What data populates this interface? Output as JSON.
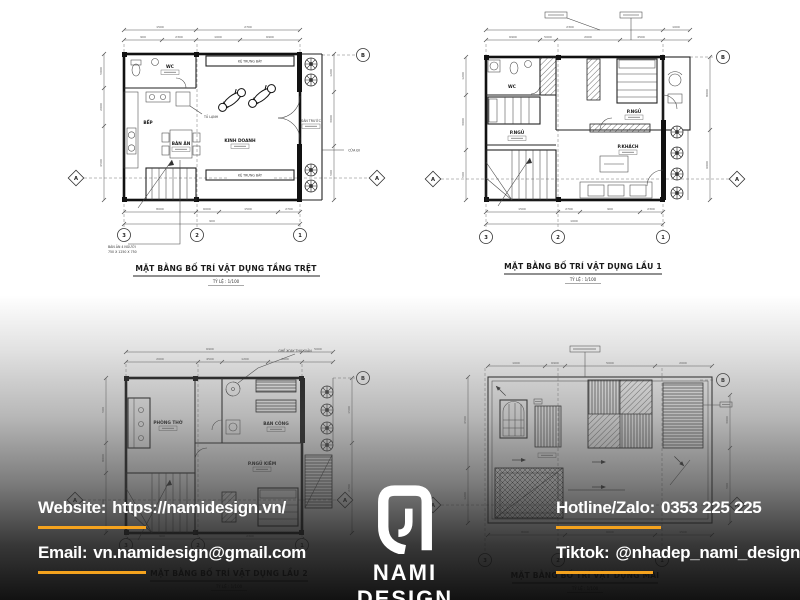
{
  "brand": {
    "name": "NAMI DESIGN",
    "accent": "#F5A31E"
  },
  "footer": {
    "website_label": "Website:",
    "website_value": "https://namidesign.vn/",
    "email_label": "Email:",
    "email_value": "vn.namidesign@gmail.com",
    "hotline_label": "Hotline/Zalo:",
    "hotline_value": "0353 225 225",
    "tiktok_label": "Tiktok:",
    "tiktok_value": "@nhadep_nami_design"
  },
  "grid": {
    "a": "A",
    "b": "B",
    "c1": "1",
    "c2": "2",
    "c3": "3"
  },
  "scale_note": "TỶ LỆ : 1/100",
  "plans": [
    {
      "caption": "MẶT BẰNG BỐ TRÍ VẬT DỤNG TẦNG TRỆT",
      "rooms": {
        "wc": "WC",
        "bep": "BẾP",
        "ban_an": "BÀN ĂN",
        "kinh_doanh": "KINH DOANH",
        "ke_trung_bay": "KỆ TRƯNG BÀY",
        "san_truoc": "SÂN TRƯỚC",
        "tu_lanh": "TỦ LẠNH",
        "cua_di": "CỬA ĐI"
      },
      "note_line1": "BÀN ĂN 4 NGƯỜI",
      "note_line2": "750 X 1250 X 750"
    },
    {
      "caption": "MẶT BẰNG BỐ TRÍ VẬT DỤNG LẦU 1",
      "rooms": {
        "wc": "WC",
        "p_ngu_1": "P.NGỦ",
        "p_ngu_2": "P.NGỦ",
        "p_khach": "P.KHÁCH",
        "ban_cong": "BAN CÔNG"
      }
    },
    {
      "caption": "MẶT BẰNG BỐ TRÍ VẬT DỤNG LẦU 2",
      "rooms": {
        "phong_tho": "PHÒNG THỜ",
        "ban_cong": "BAN CÔNG",
        "p_ngu": "P.NGỦ KIÊM",
        "ghe_note": "GHẾ XOAY THƯ GIÃN"
      }
    },
    {
      "caption": "MẶT BẰNG BỐ TRÍ VẬT DỤNG MÁI",
      "rooms": {}
    }
  ],
  "dims": [
    "1500",
    "2700",
    "900",
    "2300",
    "1000",
    "6900",
    "5000",
    "2000",
    "4500",
    "1200",
    "3000",
    "500",
    "8000",
    "6000"
  ]
}
